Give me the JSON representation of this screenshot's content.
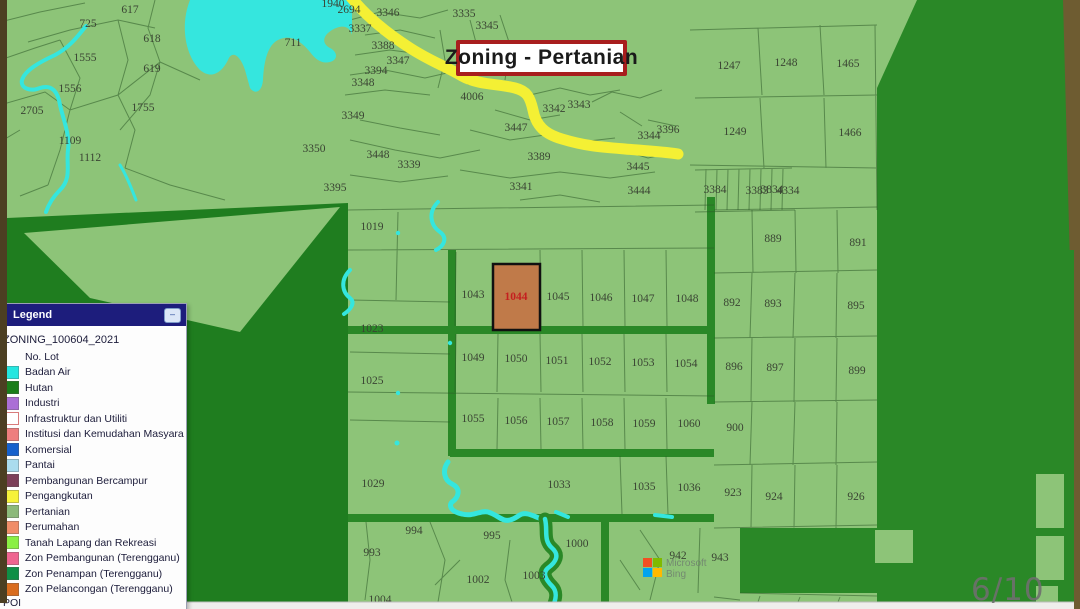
{
  "slide": {
    "page_indicator": "6/10"
  },
  "title_box": {
    "label": "Zoning - Pertanian"
  },
  "legend": {
    "title": "Legend",
    "minimize_icon": "–",
    "layer_name": "ZONING_100604_2021",
    "footer": "POI",
    "items": [
      {
        "label": "No. Lot",
        "swatch": null
      },
      {
        "label": "Badan Air",
        "swatch": "#23e6e0"
      },
      {
        "label": "Hutan",
        "swatch": "#1a7d1a"
      },
      {
        "label": "Industri",
        "swatch": "#ab6fd6"
      },
      {
        "label": "Infrastruktur dan Utiliti",
        "swatch": "#ffffff",
        "swatch_border": "#d97b7b"
      },
      {
        "label": "Institusi dan Kemudahan Masyara",
        "swatch": "#ee7e7e"
      },
      {
        "label": "Komersial",
        "swatch": "#1560cc"
      },
      {
        "label": "Pantai",
        "swatch": "#aadcee"
      },
      {
        "label": "Pembangunan Bercampur",
        "swatch": "#7c3f58"
      },
      {
        "label": "Pengangkutan",
        "swatch": "#f6f23a"
      },
      {
        "label": "Pertanian",
        "swatch": "#8cb97a"
      },
      {
        "label": "Perumahan",
        "swatch": "#f08d68"
      },
      {
        "label": "Tanah Lapang dan Rekreasi",
        "swatch": "#8aef44"
      },
      {
        "label": "Zon Pembangunan (Terengganu)",
        "swatch": "#ef6490"
      },
      {
        "label": "Zon Penampan (Terengganu)",
        "swatch": "#0f8f46"
      },
      {
        "label": "Zon Pelancongan (Terengganu)",
        "swatch": "#d96c1e"
      }
    ]
  },
  "map": {
    "colors": {
      "pertanian": "#8dc478",
      "hutan": "#2a8827",
      "hutan_deep": "#1f7d1f",
      "water": "#35e6de",
      "road_yellow": "#f4f034",
      "highlight_fill": "#c07a49",
      "highlight_text": "#c41f1f",
      "label": "#3a4433",
      "frame_brown_left": "#4c3f22",
      "frame_brown_right": "#6e5c31",
      "bottom_strip": "#efeeec",
      "page_indicator_text": "#6f6f6f"
    },
    "highlighted_lot": {
      "number": "1044"
    },
    "attribution": {
      "line1": "Microsoft",
      "line2": "Bing"
    },
    "lots": [
      {
        "n": "617",
        "x": 130,
        "y": 13
      },
      {
        "n": "725",
        "x": 88,
        "y": 27
      },
      {
        "n": "618",
        "x": 152,
        "y": 42
      },
      {
        "n": "1555",
        "x": 85,
        "y": 61
      },
      {
        "n": "619",
        "x": 152,
        "y": 72
      },
      {
        "n": "1556",
        "x": 70,
        "y": 92
      },
      {
        "n": "2705",
        "x": 32,
        "y": 114
      },
      {
        "n": "1755",
        "x": 143,
        "y": 111
      },
      {
        "n": "1109",
        "x": 70,
        "y": 144
      },
      {
        "n": "1112",
        "x": 90,
        "y": 161
      },
      {
        "n": "711",
        "x": 293,
        "y": 46
      },
      {
        "n": "3350",
        "x": 314,
        "y": 152
      },
      {
        "n": "3395",
        "x": 335,
        "y": 191
      },
      {
        "n": "1940",
        "x": 333,
        "y": 7
      },
      {
        "n": "2694",
        "x": 349,
        "y": 13
      },
      {
        "n": "3346",
        "x": 388,
        "y": 16
      },
      {
        "n": "3335",
        "x": 464,
        "y": 17
      },
      {
        "n": "3345",
        "x": 487,
        "y": 29
      },
      {
        "n": "3337",
        "x": 360,
        "y": 32
      },
      {
        "n": "3388",
        "x": 383,
        "y": 49
      },
      {
        "n": "3347",
        "x": 398,
        "y": 64
      },
      {
        "n": "3394",
        "x": 376,
        "y": 74
      },
      {
        "n": "3348",
        "x": 363,
        "y": 86
      },
      {
        "n": "4006",
        "x": 472,
        "y": 100
      },
      {
        "n": "3342",
        "x": 554,
        "y": 112
      },
      {
        "n": "3343",
        "x": 579,
        "y": 108
      },
      {
        "n": "3349",
        "x": 353,
        "y": 119
      },
      {
        "n": "3447",
        "x": 516,
        "y": 131
      },
      {
        "n": "3396",
        "x": 668,
        "y": 133
      },
      {
        "n": "3344",
        "x": 649,
        "y": 139
      },
      {
        "n": "3448",
        "x": 378,
        "y": 158
      },
      {
        "n": "3339",
        "x": 409,
        "y": 168
      },
      {
        "n": "3389",
        "x": 539,
        "y": 160
      },
      {
        "n": "3445",
        "x": 638,
        "y": 170
      },
      {
        "n": "3341",
        "x": 521,
        "y": 190
      },
      {
        "n": "3444",
        "x": 639,
        "y": 194
      },
      {
        "n": "1247",
        "x": 729,
        "y": 69
      },
      {
        "n": "1248",
        "x": 786,
        "y": 66
      },
      {
        "n": "1465",
        "x": 848,
        "y": 67
      },
      {
        "n": "1249",
        "x": 735,
        "y": 135
      },
      {
        "n": "1466",
        "x": 850,
        "y": 136
      },
      {
        "n": "3384",
        "x": 715,
        "y": 193
      },
      {
        "n": "3383",
        "x": 757,
        "y": 194
      },
      {
        "n": "3834",
        "x": 772,
        "y": 193
      },
      {
        "n": "4334",
        "x": 788,
        "y": 194
      },
      {
        "n": "1019",
        "x": 372,
        "y": 230
      },
      {
        "n": "1043",
        "x": 473,
        "y": 298
      },
      {
        "n": "1045",
        "x": 558,
        "y": 300
      },
      {
        "n": "1046",
        "x": 601,
        "y": 301
      },
      {
        "n": "1047",
        "x": 643,
        "y": 302
      },
      {
        "n": "1048",
        "x": 687,
        "y": 302
      },
      {
        "n": "1023",
        "x": 372,
        "y": 332
      },
      {
        "n": "1049",
        "x": 473,
        "y": 361
      },
      {
        "n": "1050",
        "x": 516,
        "y": 362
      },
      {
        "n": "1051",
        "x": 557,
        "y": 364
      },
      {
        "n": "1052",
        "x": 600,
        "y": 365
      },
      {
        "n": "1053",
        "x": 643,
        "y": 366
      },
      {
        "n": "1054",
        "x": 686,
        "y": 367
      },
      {
        "n": "1025",
        "x": 372,
        "y": 384
      },
      {
        "n": "889",
        "x": 773,
        "y": 242
      },
      {
        "n": "891",
        "x": 858,
        "y": 246
      },
      {
        "n": "892",
        "x": 732,
        "y": 306
      },
      {
        "n": "893",
        "x": 773,
        "y": 307
      },
      {
        "n": "895",
        "x": 856,
        "y": 309
      },
      {
        "n": "896",
        "x": 734,
        "y": 370
      },
      {
        "n": "897",
        "x": 775,
        "y": 371
      },
      {
        "n": "899",
        "x": 857,
        "y": 374
      },
      {
        "n": "1055",
        "x": 473,
        "y": 422
      },
      {
        "n": "1056",
        "x": 516,
        "y": 424
      },
      {
        "n": "1057",
        "x": 558,
        "y": 425
      },
      {
        "n": "1058",
        "x": 602,
        "y": 426
      },
      {
        "n": "1059",
        "x": 644,
        "y": 427
      },
      {
        "n": "1060",
        "x": 689,
        "y": 427
      },
      {
        "n": "900",
        "x": 735,
        "y": 431
      },
      {
        "n": "1029",
        "x": 373,
        "y": 487
      },
      {
        "n": "1033",
        "x": 559,
        "y": 488
      },
      {
        "n": "1035",
        "x": 644,
        "y": 490
      },
      {
        "n": "1036",
        "x": 689,
        "y": 491
      },
      {
        "n": "923",
        "x": 733,
        "y": 496
      },
      {
        "n": "924",
        "x": 774,
        "y": 500
      },
      {
        "n": "926",
        "x": 856,
        "y": 500
      },
      {
        "n": "994",
        "x": 414,
        "y": 534
      },
      {
        "n": "995",
        "x": 492,
        "y": 539
      },
      {
        "n": "1000",
        "x": 577,
        "y": 547
      },
      {
        "n": "993",
        "x": 372,
        "y": 556
      },
      {
        "n": "942",
        "x": 678,
        "y": 559
      },
      {
        "n": "943",
        "x": 720,
        "y": 561
      },
      {
        "n": "1002",
        "x": 478,
        "y": 583
      },
      {
        "n": "1003",
        "x": 534,
        "y": 579
      },
      {
        "n": "1004",
        "x": 380,
        "y": 603
      }
    ]
  }
}
